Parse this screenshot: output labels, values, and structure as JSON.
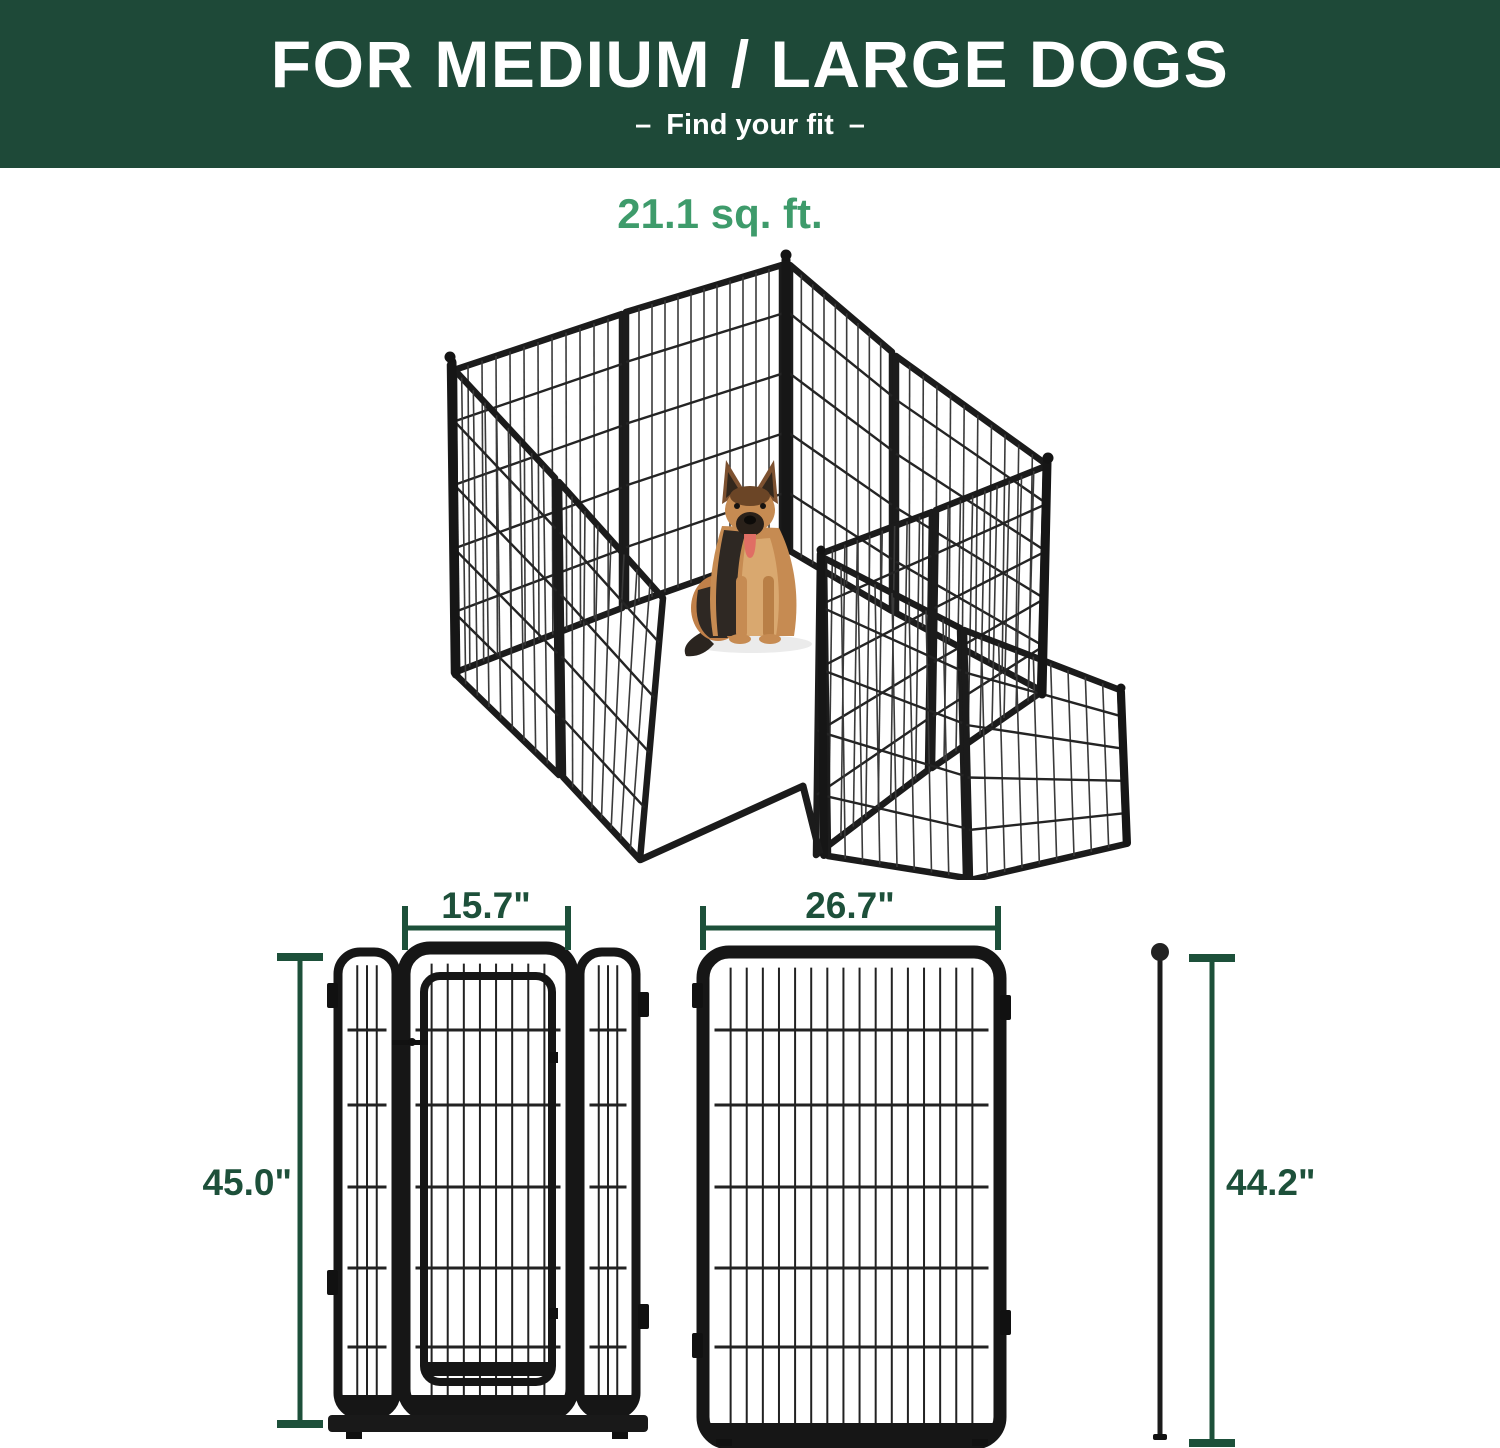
{
  "banner": {
    "title": "FOR MEDIUM / LARGE DOGS",
    "subtitle": "Find your fit",
    "dash": "–"
  },
  "area": {
    "label": "21.1 sq. ft."
  },
  "dims": {
    "door_width": "15.7\"",
    "panel_width": "26.7\"",
    "panel_height": "45.0\"",
    "connector_height": "44.2\""
  },
  "colors": {
    "banner_green": "#1e4938",
    "accent_green": "#3e9b6b",
    "dimension_green": "#1d503a",
    "metal_black": "#1b1b1b"
  }
}
